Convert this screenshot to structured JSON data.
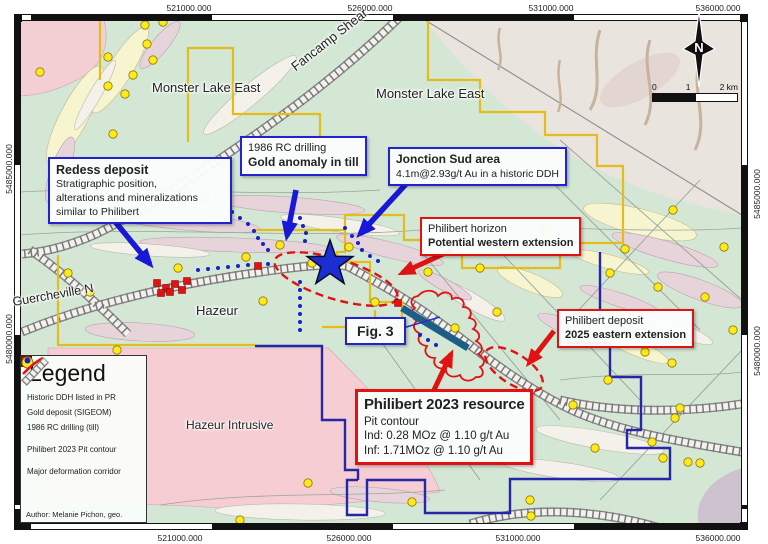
{
  "coordinates": {
    "top": [
      "521000.000",
      "526000.000",
      "531000.000",
      "536000.000"
    ],
    "bottom": [
      "521000.000",
      "526000.000",
      "531000.000",
      "536000.000"
    ],
    "left": [
      "5485000.000",
      "5480000.000"
    ],
    "right": [
      "5485000.000",
      "5480000.000"
    ]
  },
  "region_labels": {
    "monster_lake_east_1": "Monster Lake East",
    "monster_lake_east_2": "Monster Lake East",
    "fancamp_shear": "Fancamp Shear",
    "guercheville": "Guercheville N",
    "hazeur": "Hazeur",
    "hazeur_intrusive": "Hazeur Intrusive"
  },
  "callouts": {
    "redess": {
      "title": "Redess deposit",
      "body": [
        "Stratigraphic position,",
        "alterations and mineralizations",
        "similar to Philibert"
      ]
    },
    "rc_drilling": {
      "line1": "1986 RC drilling",
      "line2": "Gold anomaly in till"
    },
    "jonction": {
      "line1": "Jonction Sud area",
      "line2": "4.1m@2.93g/t Au in a historic DDH"
    },
    "horizon": {
      "line1": "Philibert horizon",
      "line2": "Potential western extension"
    },
    "deposit": {
      "line1": "Philibert deposit",
      "line2": "2025 eastern extension"
    },
    "fig3": {
      "label": "Fig. 3"
    },
    "resource": {
      "title": "Philibert 2023 resource",
      "lines": [
        "Pit contour",
        "Ind: 0.28 MOz @ 1.10 g/t Au",
        "Inf: 1.71MOz @ 1.10 g/t Au"
      ]
    }
  },
  "legend": {
    "title": "Legend",
    "items": [
      {
        "label": "Historic DDH listed in PR",
        "swatch": "red-square"
      },
      {
        "label": "Gold deposit (SIGEOM)",
        "swatch": "yellow-circle"
      },
      {
        "label": "1986 RC drilling (till)",
        "swatch": "blue-dot"
      },
      {
        "label": "Philibert 2023 Pit contour",
        "swatch": "red-line"
      },
      {
        "label": "Major deformation corridor",
        "swatch": "hatched-corridor"
      }
    ],
    "author": "Author: Melanie Pichon, geo."
  },
  "north_label": "N",
  "scalebar": {
    "ticks": [
      "0",
      "1",
      "2 km"
    ]
  },
  "colors": {
    "map_green": "#d4e7d5",
    "tan_region": "#e9e4dd",
    "intrusive_pink": "#f5cdd3",
    "band_pink": "#e7d4db",
    "band_cream": "#f7f5cf",
    "claim_yellow": "#e2bd1c",
    "claim_navy": "#2626a8",
    "annotation_blue": "#2222cf",
    "annotation_red": "#e01212",
    "star_blue": "#1b2ed1",
    "gold_dot": "#ffe81c",
    "section_teal": "#1d5e86"
  },
  "markers": {
    "gold_deposits": [
      [
        145,
        25
      ],
      [
        163,
        22
      ],
      [
        147,
        44
      ],
      [
        108,
        57
      ],
      [
        153,
        60
      ],
      [
        133,
        75
      ],
      [
        108,
        86
      ],
      [
        125,
        94
      ],
      [
        113,
        134
      ],
      [
        40,
        72
      ],
      [
        205,
        197
      ],
      [
        246,
        257
      ],
      [
        280,
        245
      ],
      [
        312,
        263
      ],
      [
        349,
        247
      ],
      [
        263,
        301
      ],
      [
        68,
        273
      ],
      [
        90,
        292
      ],
      [
        117,
        350
      ],
      [
        178,
        268
      ],
      [
        375,
        302
      ],
      [
        428,
        272
      ],
      [
        480,
        268
      ],
      [
        497,
        312
      ],
      [
        455,
        328
      ],
      [
        505,
        245
      ],
      [
        545,
        230
      ],
      [
        673,
        210
      ],
      [
        625,
        249
      ],
      [
        724,
        247
      ],
      [
        610,
        273
      ],
      [
        658,
        287
      ],
      [
        705,
        297
      ],
      [
        733,
        330
      ],
      [
        645,
        352
      ],
      [
        672,
        363
      ],
      [
        608,
        380
      ],
      [
        675,
        418
      ],
      [
        595,
        448
      ],
      [
        652,
        442
      ],
      [
        663,
        458
      ],
      [
        688,
        462
      ],
      [
        700,
        463
      ],
      [
        573,
        405
      ],
      [
        308,
        483
      ],
      [
        240,
        520
      ],
      [
        412,
        502
      ],
      [
        530,
        500
      ],
      [
        531,
        516
      ],
      [
        680,
        408
      ]
    ],
    "rc_till_dots": [
      [
        232,
        212
      ],
      [
        240,
        218
      ],
      [
        248,
        224
      ],
      [
        254,
        231
      ],
      [
        258,
        238
      ],
      [
        263,
        244
      ],
      [
        268,
        250
      ],
      [
        300,
        218
      ],
      [
        303,
        226
      ],
      [
        306,
        233
      ],
      [
        305,
        241
      ],
      [
        345,
        228
      ],
      [
        352,
        236
      ],
      [
        358,
        243
      ],
      [
        362,
        250
      ],
      [
        300,
        282
      ],
      [
        300,
        290
      ],
      [
        300,
        298
      ],
      [
        300,
        306
      ],
      [
        300,
        314
      ],
      [
        300,
        322
      ],
      [
        300,
        330
      ],
      [
        198,
        270
      ],
      [
        208,
        269
      ],
      [
        218,
        268
      ],
      [
        228,
        267
      ],
      [
        238,
        266
      ],
      [
        248,
        265
      ],
      [
        258,
        265
      ],
      [
        268,
        264
      ],
      [
        370,
        256
      ],
      [
        378,
        261
      ],
      [
        420,
        335
      ],
      [
        428,
        340
      ],
      [
        436,
        345
      ],
      [
        130,
        240
      ],
      [
        136,
        248
      ],
      [
        142,
        256
      ]
    ],
    "historic_ddh": [
      [
        157,
        283
      ],
      [
        166,
        288
      ],
      [
        175,
        284
      ],
      [
        170,
        292
      ],
      [
        182,
        290
      ],
      [
        187,
        281
      ],
      [
        161,
        293
      ],
      [
        258,
        266
      ],
      [
        398,
        303
      ]
    ]
  }
}
